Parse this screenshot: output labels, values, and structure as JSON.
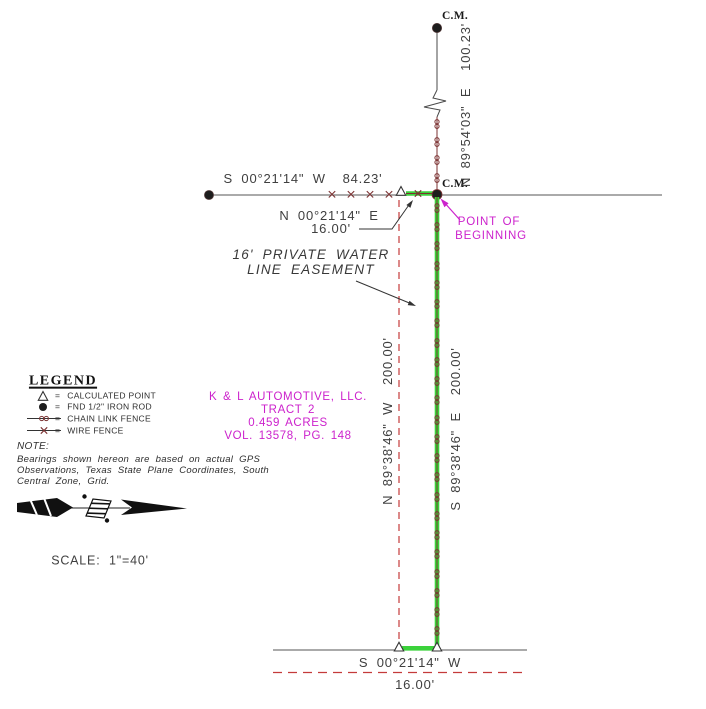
{
  "colors": {
    "magenta": "#cc22cc",
    "easement_green": "#3bd23b",
    "fence_maroon": "#7b3232",
    "dashed_red": "#c43b3b",
    "line_gray": "#4a4a4a"
  },
  "labels": {
    "cm_top": "C.M.",
    "cm_mid": "C.M.",
    "north_tie_bearing": "N 89°54'03\" E  100.23'",
    "west_line_bearing": "S 00°21'14\" W  84.23'",
    "tie_bearing": "N 00°21'14\" E",
    "tie_distance": "16.00'",
    "pob_line1": "POINT OF",
    "pob_line2": "BEGINNING",
    "easement_line1": "16' PRIVATE WATER",
    "easement_line2": "LINE EASEMENT",
    "west_boundary_bearing": "N 89°38'46\" W  200.00'",
    "east_boundary_bearing": "S 89°38'46\" E  200.00'",
    "south_line_bearing": "S 00°21'14\" W",
    "south_line_distance": "16.00'",
    "scale": "SCALE:  1\"=40'"
  },
  "owner_block": {
    "line1": "K & L AUTOMOTIVE, LLC.",
    "line2": "TRACT 2",
    "line3": "0.459 ACRES",
    "line4": "VOL. 13578, PG. 148"
  },
  "legend": {
    "title": "LEGEND",
    "items": [
      {
        "symbol": "calculated-point-triangle",
        "eq": "=",
        "label": "CALCULATED POINT"
      },
      {
        "symbol": "found-iron-rod-dot",
        "eq": "=",
        "label": "FND 1/2\" IRON ROD"
      },
      {
        "symbol": "chain-link-fence-line",
        "eq": "=",
        "label": "CHAIN LINK FENCE"
      },
      {
        "symbol": "wire-fence-line",
        "eq": "=",
        "label": "WIRE FENCE"
      }
    ]
  },
  "note": {
    "title": "NOTE:",
    "body": "Bearings shown hereon are based on actual GPS\nObservations, Texas State Plane Coordinates, South\nCentral Zone, Grid."
  }
}
